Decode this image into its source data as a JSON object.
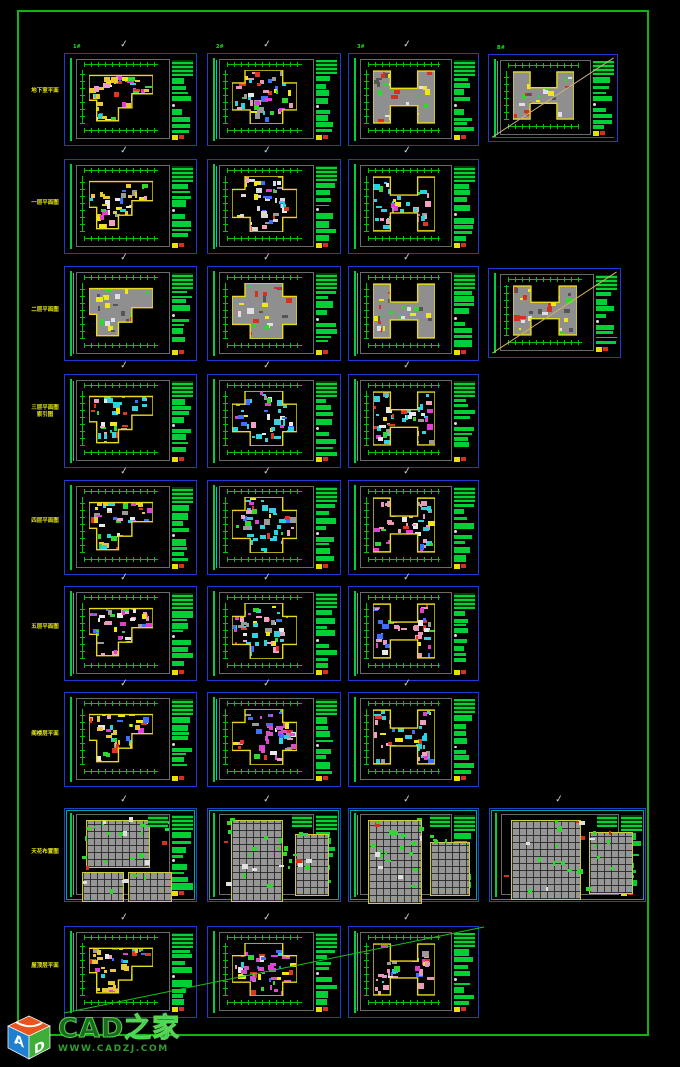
{
  "app": {
    "background": "#000000",
    "page_border_color": "#12b412"
  },
  "watermark": {
    "title": "CAD之家",
    "url": "WWW.CADZJ.COM",
    "cube": {
      "top_color": "#e8541e",
      "left_color": "#1f7fd0",
      "right_color": "#3fae36",
      "left_letter": "A",
      "right_letter": "D"
    }
  },
  "glyphs": {
    "checkmark": "✓"
  },
  "palette": {
    "frame_blue": "#2038d8",
    "detail_cyan": "#00a2a2",
    "dim_green": "#00c400",
    "text_green": "#00cf35",
    "wall_yellow": "#ead91c",
    "roof_gray": "#8f8f8f",
    "scatter": [
      "#2fd82f",
      "#29d3dd",
      "#df3fd3",
      "#e03526",
      "#efe719",
      "#e8e8e8",
      "#9a9a9a",
      "#f0a0c0",
      "#3f6fff"
    ],
    "gray_scatter": [
      "#2fd82f",
      "#e0e0e0",
      "#d83020",
      "#efe719",
      "#555555"
    ]
  },
  "row_labels": [
    {
      "text": "地下室平面",
      "top": 88
    },
    {
      "text": "一层平面图",
      "top": 200
    },
    {
      "text": "二层平面图",
      "top": 307
    },
    {
      "text": "三层平面图\n索引图",
      "top": 405
    },
    {
      "text": "四层平面图",
      "top": 518
    },
    {
      "text": "五层平面图",
      "top": 624
    },
    {
      "text": "阁楼层平面",
      "top": 731
    },
    {
      "text": "天花布置图",
      "top": 849
    },
    {
      "text": "屋顶层平面",
      "top": 963
    }
  ],
  "page_diagonal": {
    "x1": 64,
    "y1": 1013,
    "x2": 484,
    "y2": 927,
    "color": "#19c219"
  },
  "sheets": [
    {
      "id": "r1c1",
      "x": 64,
      "y": 53,
      "w": 133,
      "h": 93,
      "kind": "plan",
      "shape": "L",
      "gray": false,
      "tint": "#e8c838",
      "check": true,
      "label": "1#",
      "diag": null,
      "bottom_line": null,
      "seed": 1
    },
    {
      "id": "r1c2",
      "x": 207,
      "y": 53,
      "w": 134,
      "h": 93,
      "kind": "plan",
      "shape": "cross",
      "gray": false,
      "tint": "#e79ab8",
      "check": true,
      "label": "2#",
      "diag": null,
      "bottom_line": null,
      "seed": 2
    },
    {
      "id": "r1c3",
      "x": 348,
      "y": 53,
      "w": 131,
      "h": 93,
      "kind": "plan",
      "shape": "H",
      "gray": true,
      "tint": "#9a9a9a",
      "check": true,
      "label": "3#",
      "diag": null,
      "bottom_line": null,
      "seed": 3
    },
    {
      "id": "r1c4",
      "x": 488,
      "y": 54,
      "w": 130,
      "h": 88,
      "kind": "plan",
      "shape": "H",
      "gray": true,
      "tint": "#9a9a9a",
      "check": false,
      "label": "B#",
      "diag": "#c9b183",
      "bottom_line": "#b82440",
      "seed": 4
    },
    {
      "id": "r2c1",
      "x": 64,
      "y": 159,
      "w": 133,
      "h": 95,
      "kind": "plan",
      "shape": "L",
      "gray": false,
      "tint": "#e8c838",
      "check": true,
      "label": "",
      "diag": null,
      "bottom_line": null,
      "seed": 5
    },
    {
      "id": "r2c2",
      "x": 207,
      "y": 159,
      "w": 134,
      "h": 95,
      "kind": "plan",
      "shape": "cross",
      "gray": false,
      "tint": "#d8d8d8",
      "check": true,
      "label": "",
      "diag": null,
      "bottom_line": null,
      "seed": 6
    },
    {
      "id": "r2c3",
      "x": 348,
      "y": 159,
      "w": 131,
      "h": 95,
      "kind": "plan",
      "shape": "H",
      "gray": false,
      "tint": "#35d0e0",
      "check": true,
      "label": "",
      "diag": null,
      "bottom_line": null,
      "seed": 7
    },
    {
      "id": "r3c1",
      "x": 64,
      "y": 266,
      "w": 133,
      "h": 95,
      "kind": "plan",
      "shape": "L",
      "gray": true,
      "tint": "#9a9a9a",
      "check": true,
      "label": "",
      "diag": null,
      "bottom_line": null,
      "seed": 8
    },
    {
      "id": "r3c2",
      "x": 207,
      "y": 266,
      "w": 134,
      "h": 95,
      "kind": "plan",
      "shape": "cross",
      "gray": true,
      "tint": "#9a9a9a",
      "check": true,
      "label": "",
      "diag": null,
      "bottom_line": null,
      "seed": 9
    },
    {
      "id": "r3c3",
      "x": 348,
      "y": 266,
      "w": 131,
      "h": 95,
      "kind": "plan",
      "shape": "H",
      "gray": true,
      "tint": "#9a9a9a",
      "check": true,
      "label": "",
      "diag": null,
      "bottom_line": null,
      "seed": 10
    },
    {
      "id": "r3c4",
      "x": 488,
      "y": 268,
      "w": 133,
      "h": 90,
      "kind": "plan",
      "shape": "H",
      "gray": true,
      "tint": "#9a9a9a",
      "check": false,
      "label": "",
      "diag": "#d8b35a",
      "bottom_line": null,
      "seed": 11
    },
    {
      "id": "r4c1",
      "x": 64,
      "y": 374,
      "w": 133,
      "h": 94,
      "kind": "plan",
      "shape": "L",
      "gray": false,
      "tint": "#3ad0e0",
      "check": true,
      "label": "",
      "diag": null,
      "bottom_line": null,
      "seed": 12
    },
    {
      "id": "r4c2",
      "x": 207,
      "y": 374,
      "w": 134,
      "h": 94,
      "kind": "plan",
      "shape": "cross",
      "gray": false,
      "tint": "#3ad0e0",
      "check": true,
      "label": "",
      "diag": null,
      "bottom_line": null,
      "seed": 13
    },
    {
      "id": "r4c3",
      "x": 348,
      "y": 374,
      "w": 131,
      "h": 94,
      "kind": "plan",
      "shape": "H",
      "gray": false,
      "tint": "#3ad0e0",
      "check": true,
      "label": "",
      "diag": null,
      "bottom_line": null,
      "seed": 14
    },
    {
      "id": "r5c1",
      "x": 64,
      "y": 480,
      "w": 133,
      "h": 95,
      "kind": "plan",
      "shape": "L",
      "gray": false,
      "tint": "#e8c838",
      "check": true,
      "label": "",
      "diag": null,
      "bottom_line": null,
      "seed": 15
    },
    {
      "id": "r5c2",
      "x": 207,
      "y": 480,
      "w": 134,
      "h": 95,
      "kind": "plan",
      "shape": "cross",
      "gray": false,
      "tint": "#35d0e0",
      "check": true,
      "label": "",
      "diag": null,
      "bottom_line": null,
      "seed": 16
    },
    {
      "id": "r5c3",
      "x": 348,
      "y": 480,
      "w": 131,
      "h": 95,
      "kind": "plan",
      "shape": "H",
      "gray": false,
      "tint": "#e79ab8",
      "check": true,
      "label": "",
      "diag": null,
      "bottom_line": null,
      "seed": 17
    },
    {
      "id": "r6c1",
      "x": 64,
      "y": 586,
      "w": 133,
      "h": 95,
      "kind": "plan",
      "shape": "L",
      "gray": false,
      "tint": "#e79ab8",
      "check": true,
      "label": "",
      "diag": null,
      "bottom_line": null,
      "seed": 18
    },
    {
      "id": "r6c2",
      "x": 207,
      "y": 586,
      "w": 134,
      "h": 95,
      "kind": "plan",
      "shape": "cross",
      "gray": false,
      "tint": "#35d0e0",
      "check": true,
      "label": "",
      "diag": null,
      "bottom_line": null,
      "seed": 19
    },
    {
      "id": "r6c3",
      "x": 348,
      "y": 586,
      "w": 131,
      "h": 95,
      "kind": "plan",
      "shape": "H",
      "gray": false,
      "tint": "#e79ab8",
      "check": true,
      "label": "",
      "diag": null,
      "bottom_line": null,
      "seed": 20
    },
    {
      "id": "r7c1",
      "x": 64,
      "y": 692,
      "w": 133,
      "h": 95,
      "kind": "plan",
      "shape": "L",
      "gray": false,
      "tint": "#e8c838",
      "check": true,
      "label": "",
      "diag": null,
      "bottom_line": null,
      "seed": 21
    },
    {
      "id": "r7c2",
      "x": 207,
      "y": 692,
      "w": 134,
      "h": 95,
      "kind": "plan",
      "shape": "cross",
      "gray": false,
      "tint": "#d84fd0",
      "check": true,
      "label": "",
      "diag": null,
      "bottom_line": null,
      "seed": 22
    },
    {
      "id": "r7c3",
      "x": 348,
      "y": 692,
      "w": 131,
      "h": 95,
      "kind": "plan",
      "shape": "H",
      "gray": false,
      "tint": "#35d0e0",
      "check": true,
      "label": "",
      "diag": null,
      "bottom_line": null,
      "seed": 23
    },
    {
      "id": "r8c1",
      "x": 64,
      "y": 808,
      "w": 133,
      "h": 94,
      "kind": "detail",
      "panels": [
        [
          8,
          4,
          64,
          48
        ],
        [
          4,
          56,
          42,
          30
        ],
        [
          50,
          56,
          44,
          30
        ]
      ],
      "check": true,
      "label": "",
      "seed": 24
    },
    {
      "id": "r8c2",
      "x": 207,
      "y": 808,
      "w": 134,
      "h": 94,
      "kind": "detail",
      "panels": [
        [
          10,
          4,
          52,
          82
        ],
        [
          74,
          18,
          34,
          62
        ]
      ],
      "check": true,
      "label": "",
      "seed": 25
    },
    {
      "id": "r8c3",
      "x": 348,
      "y": 808,
      "w": 131,
      "h": 94,
      "kind": "detail",
      "panels": [
        [
          6,
          4,
          54,
          84
        ],
        [
          68,
          26,
          40,
          54
        ]
      ],
      "check": true,
      "label": "",
      "seed": 26
    },
    {
      "id": "r8c4",
      "x": 489,
      "y": 808,
      "w": 157,
      "h": 94,
      "kind": "detail",
      "panels": [
        [
          8,
          4,
          70,
          80
        ],
        [
          86,
          16,
          44,
          62
        ]
      ],
      "check": true,
      "label": "",
      "seed": 27
    },
    {
      "id": "r9c1",
      "x": 64,
      "y": 926,
      "w": 133,
      "h": 92,
      "kind": "plan",
      "shape": "L",
      "gray": false,
      "tint": "#e8c838",
      "check": true,
      "label": "",
      "diag": null,
      "bottom_line": null,
      "seed": 28
    },
    {
      "id": "r9c2",
      "x": 207,
      "y": 926,
      "w": 134,
      "h": 92,
      "kind": "plan",
      "shape": "cross",
      "gray": false,
      "tint": "#d84fd0",
      "check": true,
      "label": "",
      "diag": null,
      "bottom_line": null,
      "seed": 29
    },
    {
      "id": "r9c3",
      "x": 348,
      "y": 926,
      "w": 131,
      "h": 92,
      "kind": "plan",
      "shape": "H",
      "gray": false,
      "tint": "#e79ab8",
      "check": true,
      "label": "",
      "diag": null,
      "bottom_line": null,
      "seed": 30
    }
  ]
}
